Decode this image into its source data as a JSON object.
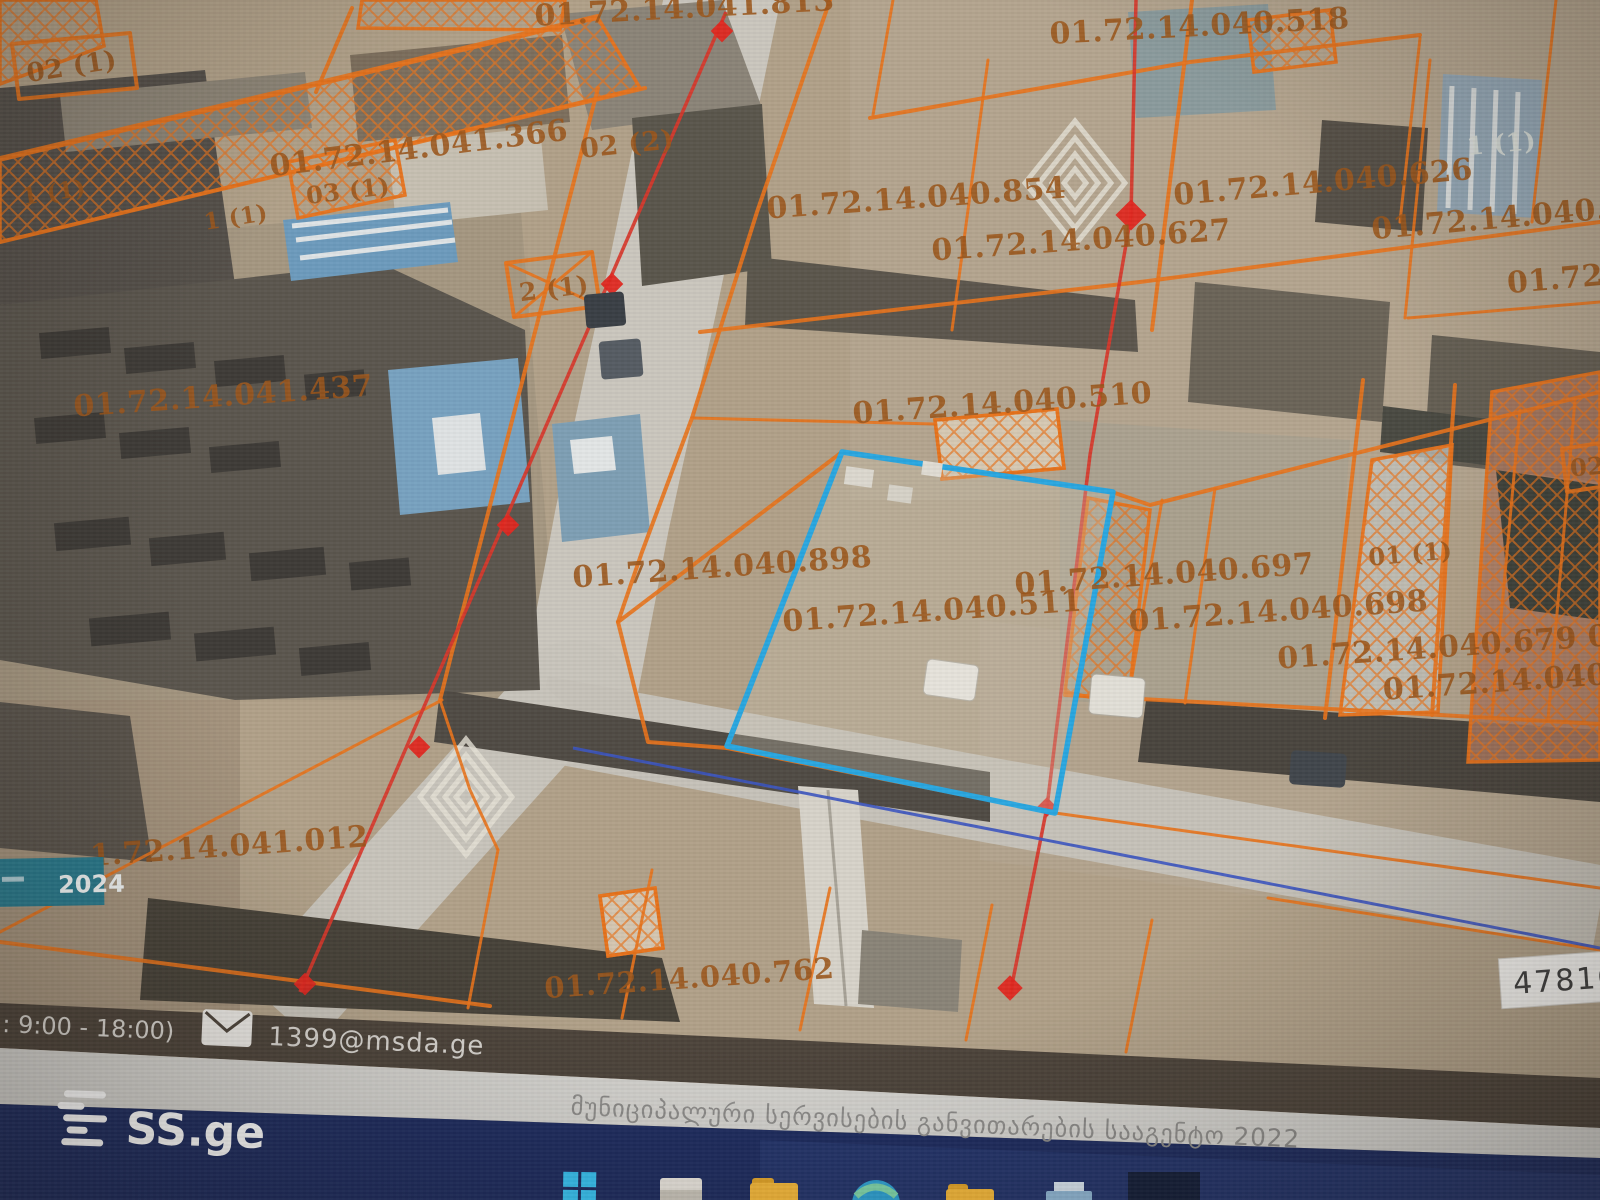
{
  "map": {
    "type": "cadastral-satellite-map",
    "parcel_line_color": "#e8731c",
    "label_color": "#9c571c",
    "highlight_parcel_color": "#2aa7e0",
    "highlighted_parcel_code": "01.72.14.040.511",
    "labels": [
      {
        "text": "01.72.14.041.813"
      },
      {
        "text": "01.72.14.040.518"
      },
      {
        "text": "02 (1)"
      },
      {
        "text": "01.72.14.041.366"
      },
      {
        "text": "02 (2)"
      },
      {
        "text": "03 (1)"
      },
      {
        "text": "1 (1)"
      },
      {
        "text": "1 (1)"
      },
      {
        "text": "2 (1)"
      },
      {
        "text": "1 (1)"
      },
      {
        "text": "01.72.14.040.854"
      },
      {
        "text": "01.72.14.040.627"
      },
      {
        "text": "01.72.14.040.626"
      },
      {
        "text": "01.72.14.040."
      },
      {
        "text": "01.72"
      },
      {
        "text": "01.72.14.041.437"
      },
      {
        "text": "01.72.14.040.510"
      },
      {
        "text": "01.72.14.040.898"
      },
      {
        "text": "01.72.14.040.511"
      },
      {
        "text": "01.72.14.040.697"
      },
      {
        "text": "01 (1)"
      },
      {
        "text": "01.72.14.040.698"
      },
      {
        "text": "01.72.14.040.679 0"
      },
      {
        "text": "01.72.14.040"
      },
      {
        "text": "02"
      },
      {
        "text": "1.72.14.041.012"
      },
      {
        "text": "01.72.14.040.762"
      }
    ],
    "ortho_year_badge": {
      "year": "2024",
      "bg": "#2a7b8e"
    }
  },
  "footer_bar": {
    "hours": ": 9:00 - 18:00)",
    "email": "1399@msda.ge",
    "bg": "#4d443b"
  },
  "agency_strip": {
    "text": "მუნიციპალური სერვისების განვითარების სააგენტო 2022"
  },
  "watermark": {
    "brand": "SS.ge"
  },
  "listing_badge": {
    "id": "478168"
  },
  "taskbar": {
    "icons": [
      {
        "name": "windows-start"
      },
      {
        "name": "file-explorer"
      },
      {
        "name": "folder"
      },
      {
        "name": "edge-browser"
      },
      {
        "name": "folder"
      },
      {
        "name": "printer"
      }
    ]
  }
}
